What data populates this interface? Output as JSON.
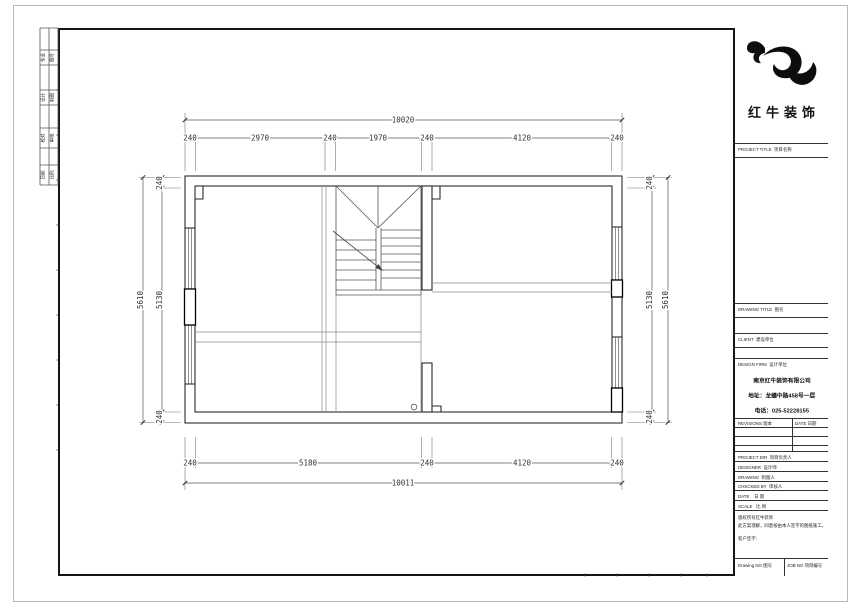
{
  "plan": {
    "top_total": "10020",
    "top_segs": [
      "240",
      "2970",
      "240",
      "1970",
      "240",
      "4120",
      "240"
    ],
    "bottom_segs": [
      "240",
      "5180",
      "240",
      "4120",
      "240"
    ],
    "bottom_total": "10011",
    "left_total": "5610",
    "left_segs": [
      "240",
      "5130",
      "240"
    ],
    "right_total": "5610",
    "right_segs": [
      "240",
      "5130",
      "240"
    ]
  },
  "signoff": {
    "rows": [
      [
        "专业",
        "图号"
      ],
      [
        "设计",
        "制图"
      ],
      [
        "校对",
        "审核"
      ],
      [
        "日期",
        "比例"
      ]
    ]
  },
  "title_block": {
    "logo_text": "红牛装饰",
    "project_label": "PROJECT TITLE",
    "project_label_cn": "项目名称",
    "drawing_label": "DRAWING TITLE",
    "drawing_label_cn": "图名",
    "client_label": "CLIENT",
    "client_label_cn": "建设单位",
    "firm_label": "DESIGN FIRM",
    "firm_label_cn": "设计单位",
    "firm_name": "南京红牛装饰有限公司",
    "firm_address": "地址：龙蟠中路458号一层",
    "firm_phone": "电话：025-52228155",
    "revisions_label": "REVISIONS",
    "revisions_label_cn": "版本",
    "date_col_label": "DATE",
    "date_col_label_cn": "日期",
    "rows": [
      {
        "en": "PROJECT DIR",
        "cn": "项目负责人"
      },
      {
        "en": "DESIGNER",
        "cn": "设计师"
      },
      {
        "en": "DRAWING",
        "cn": "制图人"
      },
      {
        "en": "CHECKED BY",
        "cn": "审核人"
      },
      {
        "en": "DATE",
        "cn": "日 期"
      },
      {
        "en": "SCALE",
        "cn": "比 例"
      }
    ],
    "note_line1": "版权所有红牛装饰",
    "note_line2": "此方案理解，同意按由本人签字的图纸施工。",
    "note_sign": "客户签字：",
    "drawing_no_label": "Drawing NO",
    "drawing_no_cn": "图号",
    "job_no_label": "JOB NO",
    "job_no_cn": "项目编号"
  }
}
